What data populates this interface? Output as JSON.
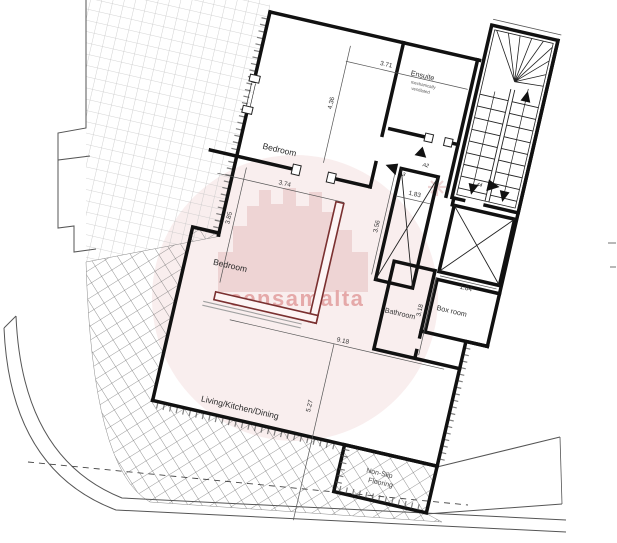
{
  "document": {
    "type": "apartment floor plan drawing",
    "background": "#ffffff"
  },
  "watermark": {
    "text": "sensamalta",
    "shape": "circle-with-castle-skyline",
    "color": "#e5a9a9"
  },
  "rooms": {
    "bedroom1": "Bedroom",
    "bedroom2": "Bedroom",
    "ensuite": "Ensuite",
    "ensuite_note_line1": "mechanically",
    "ensuite_note_line2": "ventilated",
    "box_room": "Box room",
    "bathroom": "Bathroom",
    "living": "Living/Kitchen/Dining",
    "nonslip_line1": "Non-Slip",
    "nonslip_line2": "Flooring"
  },
  "dimensions": {
    "bed1_width": "3.71",
    "bed1_depth": "4.36",
    "bed2_width": "3.74",
    "bed2_depth": "3.85",
    "lift_width": "1.83",
    "lift_depth": "3.56",
    "shaft_width": "1.84",
    "bathroom_depth": "3.18",
    "living_width": "9.18",
    "living_depth": "5.27"
  },
  "markers": {
    "a2": "A2",
    "a3": "A3",
    "m44": "44"
  },
  "colors": {
    "wall": "#111111",
    "highlight_wall": "#7a3030",
    "ghost_wall": "#a0a0a0",
    "terrace_grid": "#c6c6c6",
    "terrace_diamond": "#6f6f6f",
    "watermark_fill": "#f9eeee",
    "watermark_castle": "#eed4d4"
  }
}
